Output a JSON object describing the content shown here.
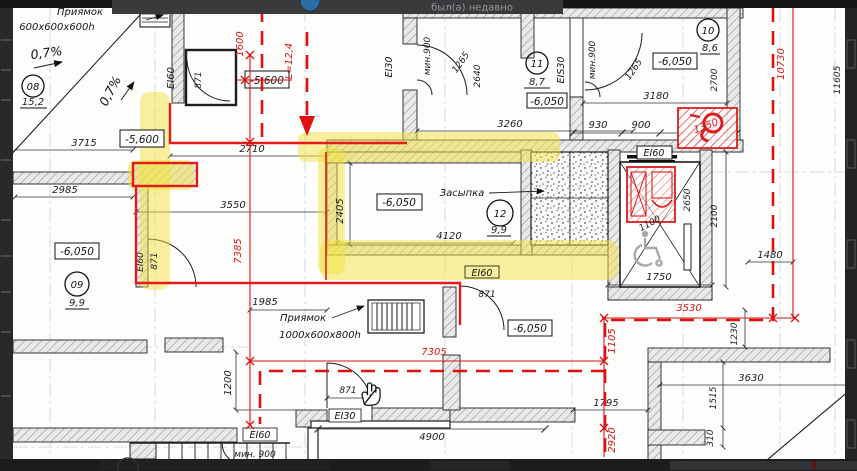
{
  "overlay": {
    "status": "был(а) недавно"
  },
  "rooms": [
    {
      "num": "08",
      "area": "15,2"
    },
    {
      "num": "09",
      "area": "9,9"
    },
    {
      "num": "10",
      "area": "8,6"
    },
    {
      "num": "11",
      "area": "8,7"
    },
    {
      "num": "12",
      "area": "9,9"
    }
  ],
  "levels": {
    "upper": "-5,600",
    "lower": "-6,050"
  },
  "fire_ratings": {
    "ei30": "EI30",
    "ei60": "EI60",
    "eis30": "EIS30"
  },
  "notes": {
    "pit_top_title": "Приямок",
    "pit_top_size": "600x600x600h",
    "pit_bottom_title": "Приямок",
    "pit_bottom_size": "1000x600x800h",
    "backfill": "Засыпка",
    "slope": "0,7%",
    "route_length": "L=12,4",
    "min_width": "мин.900",
    "min_width_floor": "мин. 900"
  },
  "dims": {
    "d3715": "3715",
    "d2985": "2985",
    "d2710": "2710",
    "d3550": "3550",
    "d2405": "2405",
    "d4120": "4120",
    "d1985": "1985",
    "d1200": "1200",
    "d871": "871",
    "d1600": "1600",
    "d7385": "7385",
    "d7305": "7305",
    "d4900": "4900",
    "d1795": "1795",
    "d2920": "2920",
    "d1105": "1105",
    "d3530": "3530",
    "d1230": "1230",
    "d3630": "3630",
    "d1515": "1515",
    "d310": "310",
    "d1480": "1480",
    "d2100": "2100",
    "d2650": "2650",
    "d1750": "1750",
    "d1100": "1100",
    "d930": "930",
    "d900": "900",
    "d1265": "1265",
    "d2640": "2640",
    "d3260": "3260",
    "d3180": "3180",
    "d2700": "2700",
    "d10730": "10730",
    "d11605": "11605",
    "d1350": "1350"
  }
}
